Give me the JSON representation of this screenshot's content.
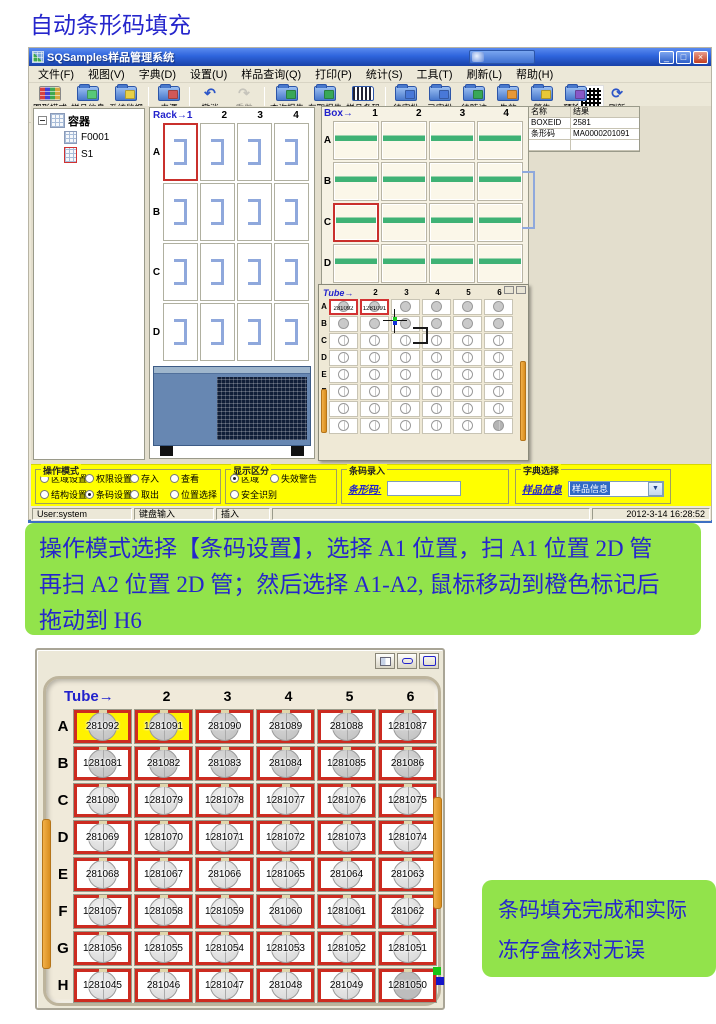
{
  "page": {
    "title": "自动条形码填充"
  },
  "app": {
    "window_title": "SQSamples样品管理系统",
    "window_buttons": {
      "minimize": "_",
      "restore": "□",
      "close": "×"
    },
    "menu": [
      "文件(F)",
      "视图(V)",
      "字典(D)",
      "设置(U)",
      "样品查询(Q)",
      "打印(P)",
      "统计(S)",
      "工具(T)",
      "刷新(L)",
      "帮助(H)"
    ],
    "toolbar": [
      {
        "label": "图形模式",
        "icon": "grid-mode"
      },
      {
        "label": "样品信息",
        "icon": "sample-info",
        "acc": "#58C878"
      },
      {
        "label": "系统监视",
        "icon": "system-monitor",
        "acc": "#E8D048"
      },
      "|",
      {
        "label": "来源",
        "icon": "source",
        "acc": "#D05858"
      },
      "|",
      {
        "label": "撤消",
        "icon": "undo"
      },
      {
        "label": "重做",
        "icon": "redo",
        "disabled": true
      },
      "|",
      {
        "label": "查询报告",
        "icon": "query-report",
        "acc": "#38A858"
      },
      {
        "label": "存取报告",
        "icon": "access-report",
        "acc": "#38A858"
      },
      {
        "label": "样品条码",
        "icon": "sample-barcode"
      },
      "|",
      {
        "label": "待审批",
        "icon": "pending-approval",
        "acc": "#4878D8"
      },
      {
        "label": "已审批",
        "icon": "approved",
        "acc": "#4878D8"
      },
      {
        "label": "待随访",
        "icon": "follow-up",
        "acc": "#38A858"
      },
      {
        "label": "失效",
        "icon": "expired",
        "acc": "#E89838"
      },
      {
        "label": "警告",
        "icon": "warning",
        "acc": "#E8C838"
      },
      {
        "label": "预输入",
        "icon": "pre-input",
        "acc": "#8858C8"
      },
      "|",
      {
        "label": "刷新",
        "icon": "refresh"
      }
    ],
    "tree": {
      "root": "容器",
      "children": [
        {
          "label": "F0001"
        },
        {
          "label": "S1",
          "selected": true
        }
      ]
    },
    "rack": {
      "header": "Rack→1",
      "cols": [
        "2",
        "3",
        "4"
      ],
      "rows": [
        "A",
        "B",
        "C",
        "D"
      ],
      "selected": "A1"
    },
    "box": {
      "label": "Box→",
      "cols": [
        "1",
        "2",
        "3",
        "4"
      ],
      "rows": [
        "A",
        "B",
        "C",
        "D"
      ],
      "selected": "C1"
    },
    "tube_small": {
      "label": "Tube→",
      "cols": [
        "2",
        "3",
        "4",
        "5",
        "6"
      ],
      "rows": [
        "A",
        "B",
        "C",
        "D",
        "E",
        "F",
        "G",
        "H"
      ],
      "selected": [
        "A1",
        "A2"
      ],
      "values": {
        "A1": "281092",
        "A2": "1281091"
      },
      "filled_rows": [
        "A",
        "B"
      ],
      "filled_cells": [
        "H6"
      ]
    },
    "results": {
      "headers": [
        "名称",
        "结果"
      ],
      "rows": [
        [
          "BOXEID",
          "2581"
        ],
        [
          "条形码",
          "MA0000201091"
        ],
        [
          "",
          ""
        ]
      ]
    },
    "bottom": {
      "op_mode": {
        "title": "操作模式",
        "rows": [
          [
            {
              "label": "区域设置"
            },
            {
              "label": "权限设置"
            },
            {
              "label": "存入"
            },
            {
              "label": "查看"
            }
          ],
          [
            {
              "label": "结构设置"
            },
            {
              "label": "条码设置",
              "on": true
            },
            {
              "label": "取出"
            },
            {
              "label": "位置选择"
            }
          ]
        ]
      },
      "display": {
        "title": "显示区分",
        "rows": [
          [
            {
              "label": "区域",
              "on": true
            },
            {
              "label": "失效警告"
            }
          ],
          [
            {
              "label": "安全识别"
            }
          ]
        ]
      },
      "barcode_entry": {
        "title": "条码录入",
        "label": "条形码:"
      },
      "dict": {
        "title": "字典选择",
        "label": "样品信息",
        "value": "样品信息",
        "arrow": "▼"
      }
    },
    "statusbar": [
      "User:system",
      "键盘输入",
      "插入"
    ],
    "timestamp": "2012-3-14 16:28:52"
  },
  "note1": {
    "lines": [
      "操作模式选择【条码设置】，选择 A1 位置，扫 A1 位置 2D 管",
      "再扫 A2 位置 2D 管；然后选择 A1-A2, 鼠标移动到橙色标记后",
      "拖动到 H6"
    ]
  },
  "chart_note": "",
  "grid": {
    "label": "Tube→",
    "cols": [
      "2",
      "3",
      "4",
      "5",
      "6"
    ],
    "rows": [
      {
        "letter": "A",
        "style": "filled",
        "cells": [
          {
            "v": "281092",
            "hl": true
          },
          {
            "v": "1281091",
            "hl": true
          },
          {
            "v": "281090"
          },
          {
            "v": "281089"
          },
          {
            "v": "281088"
          },
          {
            "v": "1281087"
          }
        ]
      },
      {
        "letter": "B",
        "style": "filled",
        "cells": [
          {
            "v": "1281081"
          },
          {
            "v": "281082"
          },
          {
            "v": "281083"
          },
          {
            "v": "281084"
          },
          {
            "v": "1281085"
          },
          {
            "v": "281086"
          }
        ]
      },
      {
        "letter": "C",
        "cells": [
          {
            "v": "281080"
          },
          {
            "v": "1281079"
          },
          {
            "v": "1281078"
          },
          {
            "v": "1281077"
          },
          {
            "v": "1281076"
          },
          {
            "v": "1281075"
          }
        ]
      },
      {
        "letter": "D",
        "cells": [
          {
            "v": "281069"
          },
          {
            "v": "1281070"
          },
          {
            "v": "1281071"
          },
          {
            "v": "1281072"
          },
          {
            "v": "1281073"
          },
          {
            "v": "1281074"
          }
        ]
      },
      {
        "letter": "E",
        "cells": [
          {
            "v": "281068"
          },
          {
            "v": "1281067"
          },
          {
            "v": "281066"
          },
          {
            "v": "1281065"
          },
          {
            "v": "281064"
          },
          {
            "v": "281063"
          }
        ]
      },
      {
        "letter": "F",
        "cells": [
          {
            "v": "1281057"
          },
          {
            "v": "1281058"
          },
          {
            "v": "1281059"
          },
          {
            "v": "281060"
          },
          {
            "v": "1281061"
          },
          {
            "v": "281062"
          }
        ]
      },
      {
        "letter": "G",
        "cells": [
          {
            "v": "1281056"
          },
          {
            "v": "1281055"
          },
          {
            "v": "1281054"
          },
          {
            "v": "1281053"
          },
          {
            "v": "1281052"
          },
          {
            "v": "1281051"
          }
        ]
      },
      {
        "letter": "H",
        "cells": [
          {
            "v": "1281045"
          },
          {
            "v": "281046"
          },
          {
            "v": "1281047"
          },
          {
            "v": "281048"
          },
          {
            "v": "281049"
          },
          {
            "v": "1281050",
            "filled": true
          }
        ]
      }
    ]
  },
  "note2": {
    "lines": [
      "条码填充完成和实际",
      "冻存盒核对无误"
    ]
  }
}
